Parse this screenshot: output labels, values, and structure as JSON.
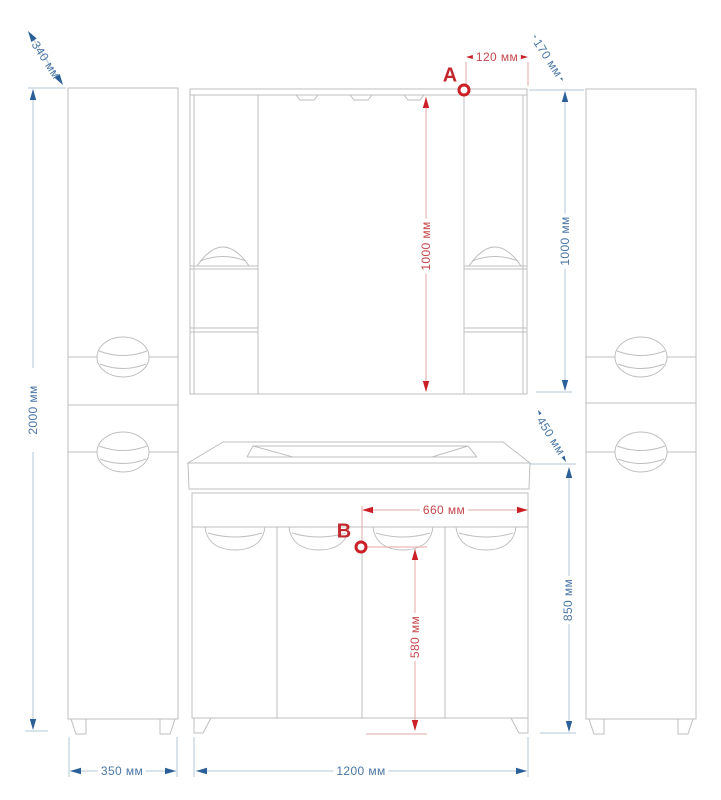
{
  "markers": {
    "a": "A",
    "b": "B"
  },
  "dimensions": {
    "cabinet_depth": "340 мм",
    "cabinet_height": "2000 мм",
    "cabinet_width": "350 мм",
    "mirror_point_a_offset": "120 мм",
    "mirror_depth": "170 мм",
    "mirror_height_center": "1000 мм",
    "mirror_height_side": "1000 мм",
    "counter_depth": "450 мм",
    "point_b_offset": "660 мм",
    "point_b_height": "580 мм",
    "vanity_height": "850 мм",
    "vanity_width": "1200 мм"
  },
  "colors": {
    "outline_gray": "#bfbfbf",
    "dimension_blue_arrow": "#2a5f98",
    "dimension_blue_line": "#b3c7da",
    "dimension_blue_text": "#4a76a4",
    "dimension_red_arrow": "#cb2027",
    "dimension_red_line": "#e6a7a8",
    "dimension_red_text": "#c4484d"
  }
}
